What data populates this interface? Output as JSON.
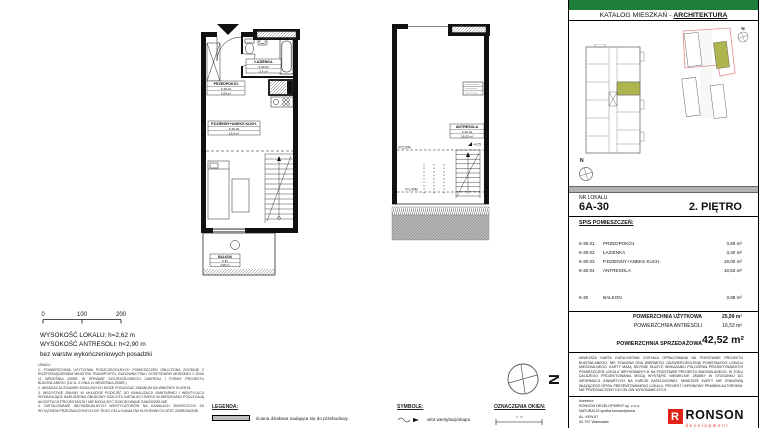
{
  "colors": {
    "green": "#1E7D36",
    "olive": "#AEB44E",
    "boundary_red": "#E08A8A",
    "logo_red": "#E2231A",
    "gray_bar": "#B2B2B2"
  },
  "compass": {
    "letter": "N"
  },
  "plans": {
    "main": {
      "rooms": [
        {
          "name": "PRZEDPOKÓJ",
          "id": "6-30.01",
          "area": "3,59 m²"
        },
        {
          "name": "ŁAZIENKA",
          "id": "6-30.02",
          "area": "3,4 m²"
        },
        {
          "name": "P.DZIENNY+ANEKS KUCH.",
          "id": "6-30.03",
          "area": "19,0 m²"
        },
        {
          "name": "BALKON",
          "id": "6-30",
          "area": "3,98 m²"
        }
      ]
    },
    "antresola": {
      "room": {
        "name": "ANTRESOLA",
        "id": "6-30.04",
        "area": "16,53 m²"
      },
      "level_mark": "+4,75",
      "height_lines": [
        "h=2,20M",
        "h=1,40M"
      ]
    }
  },
  "notes": {
    "scale": {
      "ticks": [
        "0",
        "100",
        "200"
      ]
    },
    "heights": [
      "WYSOKOŚĆ LOKALU: h=2,62 m",
      "WYSOKOŚĆ ANTRESOLI: h<2,90 m",
      "bez warstw wykończeniowych posadzki"
    ],
    "uwagi": "UWAGI:\n1. POWIERZCHNIA UŻYTKOWA POSZCZEGÓLNYCH POMIESZCZEŃ OBLICZONA ZGODNIE Z ROZPORZĄDZENIEM MINISTRA TRANSPORTU, BUDOWNICTWA I GOSPODARKI MORSKIEJ Z DNIA 11 WRZEŚNIA 2008R. W SPRAWIE SZCZEGÓŁOWEGO ZAKRESU I FORMY PROJEKTU BUDOWLANEGO (DZ.U. Z DNIA 11 WRZEŚNIA 2008R.)\n2. ARANŻACJA ŚCIANEK DZIAŁOWYCH MOŻE PODLEGAĆ ZMIANOM NA WNIOSEK KLIENTA.\n3. WSZYSTKIE ZMIANY W UKŁADZIE PODEJŚĆ DO KANALIZACJI SANITARNEJ I WENTYLACJI WYMAGAJĄCE NARUSZENIA OBUDOWY SZACHTU INSTALACYJNEGO W MIESZKANIU PODLEGAJĄ AKCEPTACJI PROJEKTANTA I NIE MOGĄ BYĆ DOKONYWANE SAMODZIELNIE.\n4. INSTALOWANIE INDYWIDUALNYCH WENTYLATORÓW NA KANAŁACH ZBIORCZYCH ZA WYJĄTKIEM PRZEZNACZONYCH DO TEGO CELU KANAŁÓW KUCHENNYCH JEST ZABRONIONE."
  },
  "legend": {
    "legenda_title": "LEGENDA:",
    "legenda_item": "ściana działowa nadająca się do przebudowy",
    "symbole_title": "SYMBOLE:",
    "symbole_item": "wlot wentylacji/okapu",
    "okna_title": "OZNACZENIA OKIEN:"
  },
  "panel": {
    "title_prefix": "KATALOG MIESZKAŃ - ",
    "title_emph": "ARCHITEKTURA",
    "nr_label": "NR LOKALU",
    "nr_value": "6A-30",
    "floor": "2. PIĘTRO",
    "spis_title": "SPIS POMIESZCZEŃ:",
    "rooms": [
      {
        "id": "6-30.01",
        "name": "PRZEDPOKÓJ",
        "area": "3,59 m²"
      },
      {
        "id": "6-30.02",
        "name": "ŁAZIENKA",
        "area": "3,40 m²"
      },
      {
        "id": "6-30.03",
        "name": "P.DZIENNY+ANEKS KUCH.",
        "area": "19,00 m²"
      },
      {
        "id": "6-30.04",
        "name": "ANTRESOLA",
        "area": "16,53 m²"
      }
    ],
    "balkon_row": {
      "id": "6-30",
      "name": "BALKON",
      "area": "3,98 m²"
    },
    "totals": [
      {
        "label": "POWIERZCHNIA UŻYTKOWA",
        "value": "25,99 m²"
      },
      {
        "label": "POWIERZCHNIA ANTRESOLI",
        "value": "16,53 m²"
      }
    ],
    "sale": {
      "label": "POWIERZCHNIA SPRZEDAŻOWA",
      "value": "42,52 m²"
    },
    "disclaimer": "NINIEJSZA KARTA KATALOGOWA ZOSTAŁA OPRACOWANA NA PODSTAWIE PROJEKTU BUDOWLANEGO. NIE STANOWI ONA WIERNEGO ODZWIERCIEDLENIA POWSTAŁEGO LOKALU MIESZKALNEGO. KARTY MAJĄ JEDYNIE SŁUŻYĆ WSKAZANIU POŁOŻENIA PROJEKTOWANYCH POMIESZCZEŃ LOKALU WRYSOWANYCH NA PODSTAWIE PROJEKTU BUDOWLANEGO. W TOKU DALSZEGO PROJEKTOWANIA MOGĄ WYSTĄPIĆ NIEWIELKIE ZMIANY W STOSUNKU DO INFORMACJI ZAWARTYCH NA KARCIE KATALOGOWEJ. NINIEJSZE KARTY NIE STANOWIĄ WIĄŻĄCEGO OPISU PREZENTOWANEGO LOKALU. PROJEKT CHRONIONY PRAWEM AUTORSKIM. NIE PRZEZNACZONY DO CELÓW WYKONAWCZYCH.",
    "footer_lines": [
      "Inwestor:",
      "RONSON DEVELOPMENT sp. z o.o.",
      "NATURALIS spółka komandytowa",
      "AL. KEN 57",
      "02-797 Warszawa"
    ],
    "logo": {
      "text": "RONSON",
      "sub": "development"
    }
  }
}
